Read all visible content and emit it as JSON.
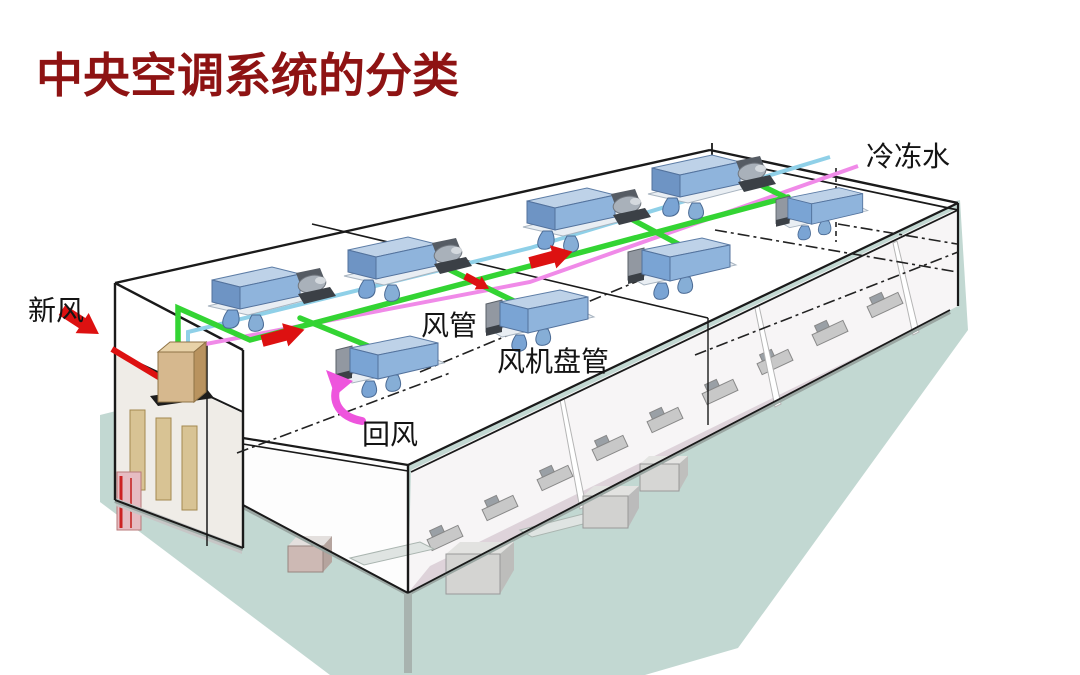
{
  "title": "中央空调系统的分类",
  "labels": {
    "chilled_water": "冷冻水",
    "fresh_air": "新风",
    "air_duct": "风管",
    "fan_coil_unit": "风机盘管",
    "return_air": "回风"
  },
  "colors": {
    "title": "#8e1313",
    "label_text": "#141414",
    "duct_green": "#33d433",
    "pipe_pink": "#f08ae8",
    "pipe_blue": "#8fd0e8",
    "arrow_red": "#dd1111",
    "fresh_air_duct_red": "#dd1111",
    "return_arrow_pink": "#ee55dd",
    "ground_teal": "#c2d8d2",
    "unit_blue": "#8fb4dc"
  },
  "equipment": {
    "fan_coil_units_back_row": 4,
    "fan_coil_units_front_row": 4,
    "air_handling_units": 1,
    "supply_air_arrows": 3
  }
}
